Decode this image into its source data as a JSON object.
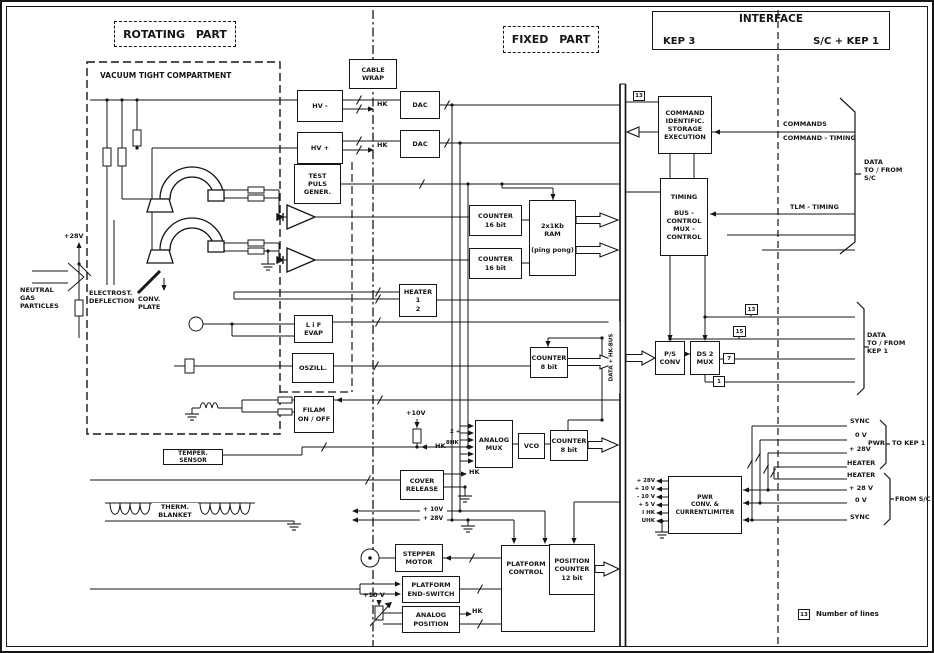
{
  "colors": {
    "ink": "#161616",
    "paper": "#ffffff"
  },
  "zones": {
    "rotating_part": "ROTATING PART",
    "fixed_part": "FIXED PART",
    "interface_title": "INTERFACE",
    "interface_left": "KEP 3",
    "interface_right": "S/C + KEP 1",
    "vacuum_compartment": "VACUUM  TIGHT  COMPARTMENT"
  },
  "blocks": {
    "cable_wrap": "CABLE\nWRAP",
    "hv_minus": "HV -",
    "hv_plus": "HV +",
    "dac_1": "DAC",
    "dac_2": "DAC",
    "test_puls": "TEST\nPULS\nGENER.",
    "counter16_a": "COUNTER\n16 bit",
    "counter16_b": "COUNTER\n16 bit",
    "ram": "2x1Kb\nRAM\n\n(ping pong)",
    "heater": "HEATER\n1\n2",
    "lif_evap": "L i F\nEVAP",
    "oszill": "OSZILL.",
    "counter8_a": "COUNTER\n8 bit",
    "filam": "FILAM\nON / OFF",
    "temper_sensor": "TEMPER. SENSOR",
    "analog_mux": "ANALOG\nMUX",
    "vco": "VCO",
    "counter8_b": "COUNTER\n8 bit",
    "cover_release": "COVER\nRELEASE",
    "therm_blanket": "THERM.\nBLANKET",
    "stepper_motor": "STEPPER\nMOTOR",
    "platform_end_switch": "PLATFORM\nEND-SWITCH",
    "analog_position": "ANALOG\nPOSITION",
    "platform_control": "PLATFORM\nCONTROL",
    "position_counter": "POSITION\nCOUNTER\n12 bit",
    "command": "COMMAND\nIDENTIFIC.\nSTORAGE\nEXECUTION",
    "timing": "TIMING\n\nBUS -\nCONTROL\nMUX -\nCONTROL",
    "ps_conv": "P/S\nCONV",
    "ds2_mux": "DS 2\nMUX",
    "pwr": "PWR\nCONV. &\nCURRENTLIMITER"
  },
  "labels": {
    "neutral_gas": "NEUTRAL\nGAS\nPARTICLES",
    "electrost": "ELECTROST.\nDEFLECTION",
    "conv_plate": "CONV.\nPLATE",
    "v28_left": "+28V",
    "hk_1": "HK",
    "hk_2": "HK",
    "hk_3": "HK",
    "hk_4": "HK",
    "hk_5": "HK",
    "v10_mid": "+10V",
    "mux_in_a": "2 +",
    "mux_in_b": "8HK",
    "v10_dist": "+ 10V",
    "v28_dist": "+ 28V",
    "v10_pos": "+10 V",
    "bus": "DATA + HK-BUS",
    "commands": "COMMANDS",
    "command_timing": "COMMAND - TIMING",
    "tlm_timing": "TLM - TIMING",
    "data_sc": "DATA\nTO / FROM\nS/C",
    "data_kep1": "DATA\nTO / FROM\nKEP 1",
    "sync_out": "SYNC",
    "v0_out": "0 V",
    "pwr_group": "PWR",
    "v28_out": "+ 28V",
    "heater_out": "HEATER",
    "to_kep1": "TO KEP 1",
    "heater_in": "HEATER",
    "v28_in": "+ 28 V",
    "v0_in": "0 V",
    "sync_in": "SYNC",
    "from_sc": "FROM S/C",
    "pwr_rails": "+ 28V\n+ 10 V\n- 10 V\n+  5 V\nI HK\nUHK"
  },
  "line_numbers": {
    "cmd": "13",
    "n13": "13",
    "n15": "15",
    "n7": "7",
    "n1": "1",
    "legend_num": "13"
  },
  "legend": {
    "text": "Number of lines"
  }
}
